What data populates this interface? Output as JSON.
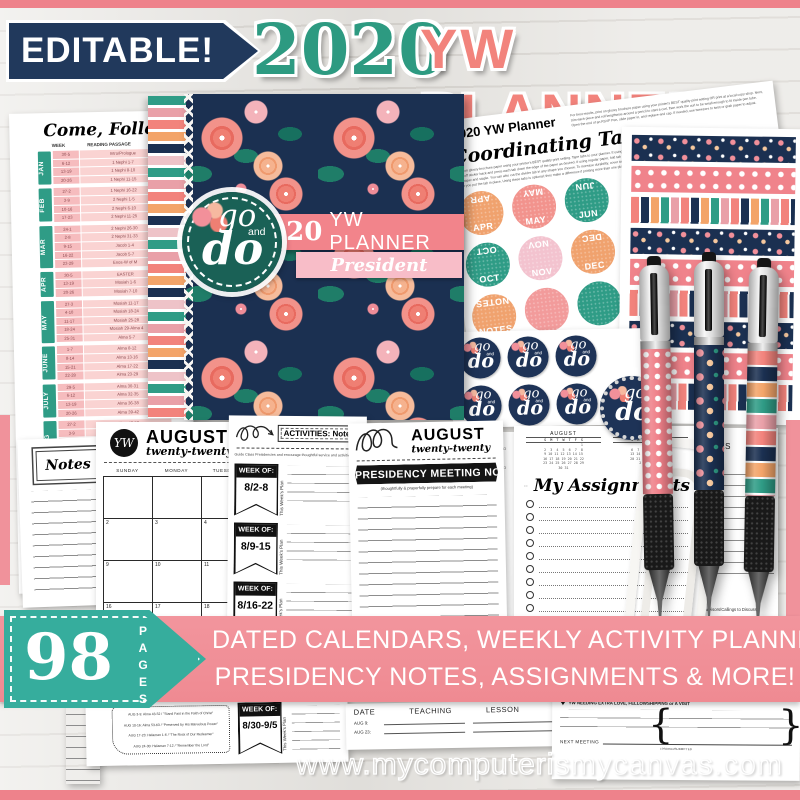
{
  "header": {
    "badge": "EDITABLE!",
    "year": "2020",
    "title": "YW PLANNER"
  },
  "colors": {
    "coral": "#f2837c",
    "pink_banner": "#f19099",
    "navy": "#1b3051",
    "teal": "#2f9c86",
    "tag_teal": "#36ad9d",
    "blush": "#f8bdc8"
  },
  "reading_page": {
    "title": "Come, Follow Me",
    "col_week": "WEEK",
    "col_passage": "READING PASSAGE",
    "months": [
      {
        "tab": "JAN",
        "rows": [
          [
            "30-5",
            "Intro/Prologue"
          ],
          [
            "6-12",
            "1 Nephi 1-7"
          ],
          [
            "13-19",
            "1 Nephi 8-10"
          ],
          [
            "20-26",
            "1 Nephi 11-15"
          ]
        ]
      },
      {
        "tab": "FEB",
        "rows": [
          [
            "27-2",
            "1 Nephi 16-22"
          ],
          [
            "3-9",
            "2 Nephi 1-5"
          ],
          [
            "10-16",
            "2 Nephi 6-10"
          ],
          [
            "17-23",
            "2 Nephi 11-25"
          ]
        ]
      },
      {
        "tab": "MAR",
        "rows": [
          [
            "24-1",
            "2 Nephi 26-30"
          ],
          [
            "2-8",
            "2 Nephi 31-33"
          ],
          [
            "9-15",
            "Jacob 1-4"
          ],
          [
            "16-22",
            "Jacob 5-7"
          ],
          [
            "23-29",
            "Enos-W of M"
          ]
        ]
      },
      {
        "tab": "APR",
        "rows": [
          [
            "30-5",
            "EASTER"
          ],
          [
            "13-19",
            "Mosiah 1-6"
          ],
          [
            "20-26",
            "Mosiah 7-10"
          ]
        ]
      },
      {
        "tab": "MAY",
        "rows": [
          [
            "27-3",
            "Mosiah 11-17"
          ],
          [
            "4-10",
            "Mosiah 18-24"
          ],
          [
            "11-17",
            "Mosiah 25-28"
          ],
          [
            "18-24",
            "Mosiah 29-Alma 4"
          ],
          [
            "25-31",
            "Alma 5-7"
          ]
        ]
      },
      {
        "tab": "JUNE",
        "rows": [
          [
            "1-7",
            "Alma 8-12"
          ],
          [
            "8-14",
            "Alma 13-16"
          ],
          [
            "15-21",
            "Alma 17-22"
          ],
          [
            "22-28",
            "Alma 23-29"
          ]
        ]
      },
      {
        "tab": "JULY",
        "rows": [
          [
            "29-5",
            "Alma 30-31"
          ],
          [
            "6-12",
            "Alma 32-35"
          ],
          [
            "13-19",
            "Alma 36-38"
          ],
          [
            "20-26",
            "Alma 39-42"
          ]
        ]
      },
      {
        "tab": "AUG",
        "rows": [
          [
            "27-2",
            "Alma 43-52"
          ],
          [
            "3-9",
            "Alma 53-63"
          ],
          [
            "10-16",
            "Helaman 1-6"
          ],
          [
            "17-23",
            "Helaman 7-12"
          ],
          [
            "24-30",
            "Helaman 13-16"
          ]
        ]
      },
      {
        "tab": "SEPT",
        "rows": [
          [
            "31-6",
            "3 Nephi 1-7"
          ],
          [
            "7-13",
            "3 Nephi 8-11"
          ],
          [
            "14-20",
            "3 Nephi 12-16"
          ],
          [
            "21-27",
            "3 Nephi 17-19"
          ]
        ]
      }
    ]
  },
  "cover": {
    "year": "2020",
    "title": "YW PLANNER",
    "subtitle": "President",
    "badge": {
      "go": "go",
      "and": "and",
      "do": "do"
    }
  },
  "instructions_page": {
    "title": "2020 YW Planner",
    "intro": "For best results, print on glossy brochure paper using your printer's BEST quality print setting OR print at a local copy shop. Next, trim each piece and roll lengthwise around a pencil to start a curl, then work the curl to be small enough to fit inside pen tube. Open the end of an RSVP Pen, slide paper in, and replace end cap. If needed, use tweezers to twist or grab paper to adjust.",
    "heading": "Coordinating Tabs",
    "body": "Print on glossy brochure paper using your printer's BEST quality print setting. Tape tabs to your planner. If using sticker paper, peel off sticker back and press each tab down the edge of the paper as desired. If using regular paper, fold tab over the edge of the paper and staple. You can also cut the divider tab in any shape you choose. To increase durability, cover tab with clear tape after you put the tab in place. Using these tabs is optional; they make a difference if printing more than one planner."
  },
  "tab_sheet": {
    "rows": [
      [
        {
          "label": "APR",
          "color": "#f0a26e"
        },
        {
          "label": "MAY",
          "color": "#f2938d"
        },
        {
          "label": "JUN",
          "color": "#2f9c86"
        }
      ],
      [
        {
          "label": "OCT",
          "color": "#2f9c86"
        },
        {
          "label": "NOV",
          "color": "#f3c3cf"
        },
        {
          "label": "DEC",
          "color": "#f0a26e"
        }
      ],
      [
        {
          "label": "NOTES",
          "color": "#f0a26e"
        },
        {
          "label": "",
          "color": "#f29b9b"
        },
        {
          "label": "",
          "color": "#2f9c86"
        }
      ]
    ]
  },
  "sticker_sheet": {
    "count": 8,
    "go": "go",
    "and": "and",
    "do": "do"
  },
  "notes_page": {
    "label": "Notes"
  },
  "calendar_page": {
    "monogram": "YW",
    "month": "AUGUST",
    "year_script": "twenty-twenty",
    "days": [
      "SUNDAY",
      "MONDAY",
      "TUESDAY",
      "WEDNESDAY"
    ],
    "weeks": [
      [
        "",
        "",
        "",
        ""
      ],
      [
        "2",
        "3",
        "4",
        "5"
      ],
      [
        "9",
        "10",
        "11",
        "12"
      ],
      [
        "16",
        "17",
        "18",
        "19"
      ]
    ]
  },
  "activities_page": {
    "box_label": "ACTIVITIES: Notes",
    "subtitle": "Guide Class Presidencies and encourage thoughtful service and activities",
    "week_of_label": "WEEK OF:",
    "vertical_label": "This Week's Plan",
    "weeks": [
      "8/2-8",
      "8/9-15",
      "8/16-22"
    ]
  },
  "presidency_page": {
    "month": "AUGUST",
    "year_script": "twenty-twenty",
    "banner": "PRESIDENCY MEETING NOTES",
    "subtitle": "(thoughtfully & prayerfully prepare for each meeting)"
  },
  "assignments_page": {
    "title": "My Assignments",
    "mini_calendars": [
      {
        "title": "AUGUST",
        "head": "S  M  T  W  T  F  S",
        "rows": [
          "                  1",
          "2  3  4  5  6  7  8",
          "9 10 11 12 13 14 15",
          "16 17 18 19 20 21 22",
          "23 24 25 26 27 28 29",
          "30 31"
        ]
      },
      {
        "title": "SEPTEMBER",
        "head": "S  M  T  W  T  F  S",
        "rows": [
          "      1  2  3  4  5",
          "6  7  8  9 10 11 12",
          "13 14 15 16 17 18 19",
          "20 21 22 23 24 25 26",
          "27 28 29 30"
        ]
      }
    ]
  },
  "presidencies_page": {
    "header_fragment": "NCIES",
    "sub_fragment": "ns, Etc.",
    "footer": "Advisors/Callings to Discuss"
  },
  "banner": {
    "count": "98",
    "pages_label": "PAGES",
    "line1": "DATED CALENDARS, WEEKLY ACTIVITY PLANNERS",
    "line2": "PRESIDENCY NOTES, ASSIGNMENTS & MORE!"
  },
  "bottom": {
    "reading_fragment": {
      "lines": [
        "AUG 3-9: Alma 43-52 / \"Stand Fast in the Faith of Christ\"",
        "AUG 10-16: Alma 53-63 / \"Preserved by His Marvelous Power\"",
        "AUG 17-23: Helaman 1-6 / \"The Rock of Our Redeemer\"",
        "AUG 24-30: Helaman 7-12 / \"Remember the Lord\""
      ],
      "flag_week": "8/30-9/5",
      "week_of_label": "WEEK OF:",
      "vertical_label": "This Week's Plan"
    },
    "teaching_table": {
      "headers": [
        "DATE",
        "TEACHING",
        "LESSON"
      ],
      "rows": [
        "AUG 9:",
        "AUG 23:"
      ]
    },
    "love_page": {
      "heart_line": "YW NEEDING EXTRA LOVE, FELLOWSHIPPING or A VISIT",
      "next_meeting_label": "NEXT MEETING",
      "tiny_label": "I PRAYED/SUBMITTED"
    }
  },
  "watermark": {
    "text": "www.mycomputerismycanvas.com"
  },
  "icons": {
    "heart": "♥",
    "flower": "flower-dots",
    "paperclip": "paperclip-shape"
  }
}
